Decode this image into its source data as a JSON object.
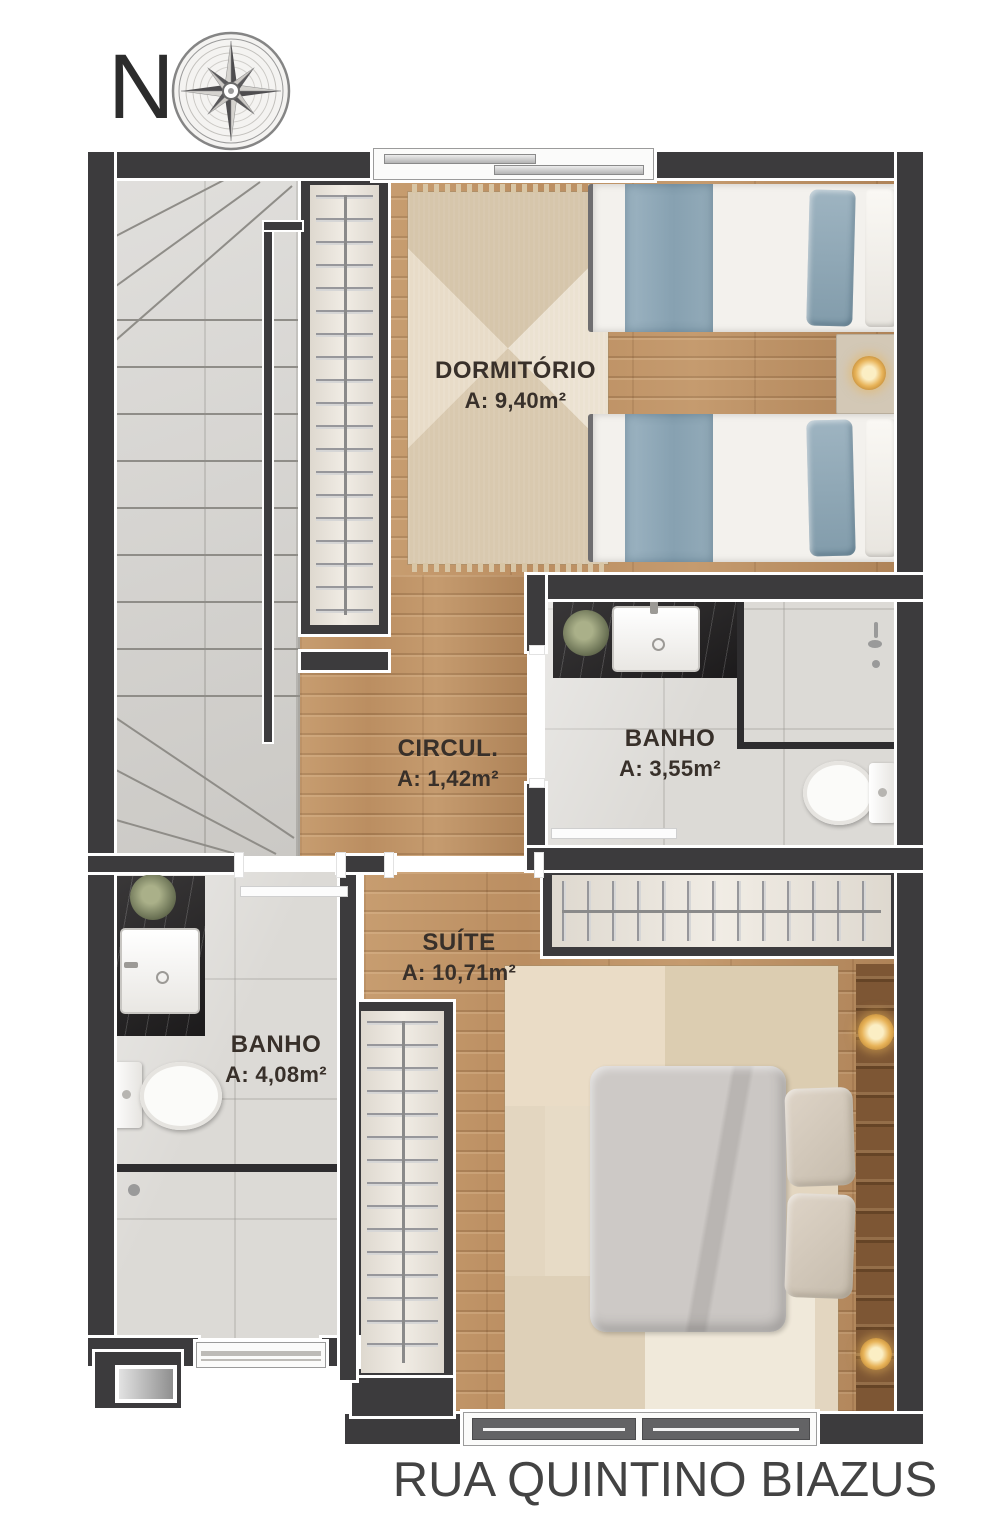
{
  "compass": {
    "north_label": "N"
  },
  "rooms": [
    {
      "id": "dormitorio",
      "name": "DORMITÓRIO",
      "area": "A: 9,40m²"
    },
    {
      "id": "banho-superior",
      "name": "BANHO",
      "area": "A: 3,55m²"
    },
    {
      "id": "circulacao",
      "name": "CIRCUL.",
      "area": "A: 1,42m²"
    },
    {
      "id": "suite",
      "name": "SUÍTE",
      "area": "A: 10,71m²"
    },
    {
      "id": "banho-suite",
      "name": "BANHO",
      "area": "A: 4,08m²"
    }
  ],
  "street": {
    "name": "RUA QUINTINO BIAZUS"
  },
  "icons": {
    "compass_rose": "8-point compass rose",
    "lamp": "bedside lamp glow",
    "plant": "potted plant",
    "shower": "shower fixture"
  },
  "colors": {
    "wall": "#3c3b3d",
    "wood_floor": "#bb8e61",
    "tile_floor": "#dcdad6",
    "stairs_floor": "#d3d1cd",
    "closet_interior": "#ece6dc",
    "bedding_blue": "#93abb9",
    "bedding_gray": "#c9c5c2",
    "rug_beige": "#e3d6c0",
    "marble_counter": "#232122",
    "lamp_gold": "#e2a94e",
    "label_text": "#38302a",
    "street_text": "#434343"
  }
}
